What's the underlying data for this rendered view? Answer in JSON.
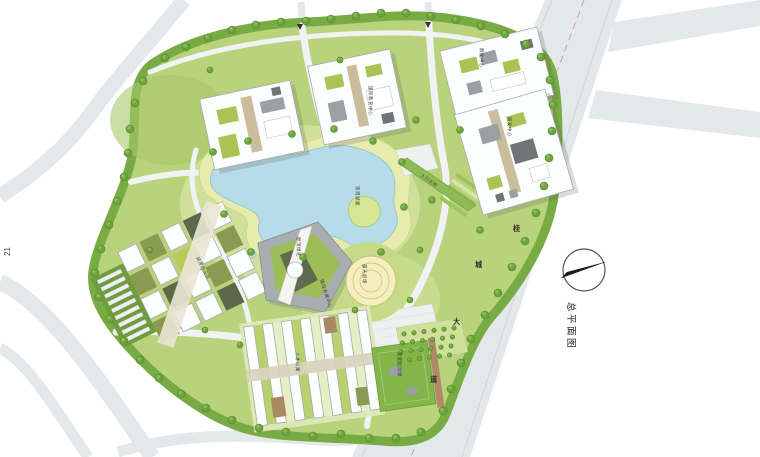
{
  "page": {
    "number": "21",
    "title": "总平面图"
  },
  "plan": {
    "road_name": {
      "chars": [
        "桂",
        "城",
        "大",
        "道"
      ]
    },
    "labels": {
      "lake": "景观湖面",
      "amphitheater": "露天剧场",
      "green_roof": "屋顶绿化",
      "conference_center": "国际会展中心",
      "education_center": "国际教育中心",
      "incubator_center": "孵化中心",
      "research_center": "研发中心",
      "office_cluster": "研发办公区",
      "apartments": "人才公寓",
      "sports_field": "室外运动场",
      "footbridge": "人行天桥"
    },
    "compass_icon": "north-arrow",
    "colors": {
      "road": "#e3e8ea",
      "site_green": "#b9d27c",
      "lake": "#b5dce8",
      "centerline_red": "#d98f8f"
    }
  }
}
